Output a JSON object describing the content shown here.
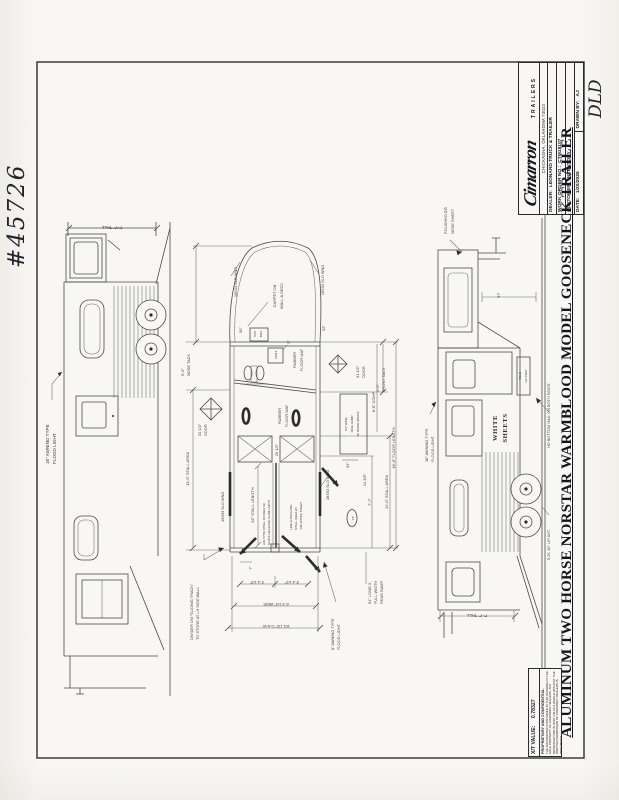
{
  "page": {
    "ref_number": "#45726",
    "initials": "DLD"
  },
  "colors": {
    "ink": "#4a4a4a",
    "paper": "#f8f7f3"
  },
  "title_block": {
    "brand": "Cimarron",
    "brand_sub": "TRAILERS",
    "address": "CHICKASHA, OKLAHOMA 73023",
    "dealer_label": "DEALER:",
    "dealer": "LEONARD TRUCK & TRAILER",
    "work_order_label": "WORK ORDER NO.:",
    "work_order": "CTM18107",
    "customer_label": "CUSTOMER:",
    "customer": "INVENTORY",
    "date_label": "DATE:",
    "date": "1/20/2026",
    "drawn_by_label": "DRAWN BY:",
    "drawn_by": "AJ"
  },
  "drawing_title": "ALUMINUM TWO HORSE NORSTAR WARMBLOOD MODEL GOOSENECK TRAILER",
  "footer": {
    "xt_label": "X/T VALUE:",
    "xt_value": "0.78327",
    "prop_title": "PROPRIETARY AND CONFIDENTIAL",
    "prop_body": "THE INFORMATION CONTAINED IN THIS DRAWING IS THE SOLE PROPERTY OF CIMARRON TRAILERS. ANY REPRODUCTION IN PART OR AS A WHOLE WITHOUT THE WRITTEN PERMISSION OF CIMARRON TRAILERS IS PROHIBITED."
  },
  "left_view": {
    "dim_tall": "7'-7\" TALL",
    "flood_1": "16\" AWNING TYPE",
    "flood_2": "FLOOD LIGHT"
  },
  "right_view": {
    "nose_1": "POLISHED S/S",
    "nose_2": "NOSE SHEET",
    "dim_57": "57\"",
    "step_1": "FOLD",
    "step_2": "UP STEP",
    "white_1": "WHITE",
    "white_2": "SHEETS",
    "bottom_rail": "HD BOTTOM RAIL ON BOTH SIDES",
    "axle": "5.2K 10\" LIP AXT.",
    "flood_1": "16\" AWNING TYPE",
    "flood_2": "FLOOD LIGHT",
    "dim_tall": "7'-7\" TALL"
  },
  "plan": {
    "nose_window": "19X34 SLD WND",
    "dim_50": "50\"",
    "dim_52": "52\"",
    "carpet_1": "CARPET ON",
    "carpet_2": "WALL & DECK",
    "hat_box_1": "HAT",
    "hat_box_2": "BOX",
    "vent": "VENT",
    "dim_5": "5\"",
    "nose_tack_1": "5'-0\"",
    "nose_tack_2": "NOSE TACK",
    "front_tack_1": "4'-0\"",
    "front_tack_2": "FRONT TACK",
    "door_31": "31 1/2\"",
    "door_word": "DOOR",
    "rubber_1": "RUBBER",
    "rubber_2": "FLOOR MAT",
    "stall_window": "19X53 SLD WND",
    "stall_length": "82\" STALL LENGTH",
    "insulate_1": "LINE & INSULATE",
    "insulate_2": "STALL AREA W/",
    "insulate_3": ".032 WHITE SHEET",
    "divider_note_1": "AIR TYPE STALL DIVIDER W/",
    "divider_note_2": "QUICK RELEASE SLAM LATCH",
    "dim_25": "25 1/2\"",
    "side_ramp_1": "54\" WIDE",
    "side_ramp_2": "SIDE RAMP",
    "side_ramp_3": "W/ DOOR ABOVE",
    "dim_54": "54\"",
    "dim_14_38": "14 3/8\"",
    "dim_7_7": "7'-7\"",
    "stall_area_left": "13'-0\" STALL AREA",
    "stall_area_right": "14'-0\" STALL AREA",
    "floor_length": "16'-0\" FLOOR LENGTH",
    "comp": "6'-8\" COMP",
    "bubble_74": "74\"",
    "divider_track_1": "DIVIDER ON \"SLIDING TRACK\"",
    "divider_track_2": "TO STORE AT LH SIDE WALL",
    "dim_7": "7\"",
    "stall_width": "3'-4 1/2\"",
    "overall_wide": "6'-9 1/4\" WIDE",
    "oaw": "101 1/2\" O.A.W.",
    "flood8_1": "8\" AWNING TYPE",
    "flood8_2": "FLOOD LIGHT",
    "rear_ramp_1": "54\" LONG X",
    "rear_ramp_2": "FULL WIDTH",
    "rear_ramp_3": "REAR RAMP"
  }
}
